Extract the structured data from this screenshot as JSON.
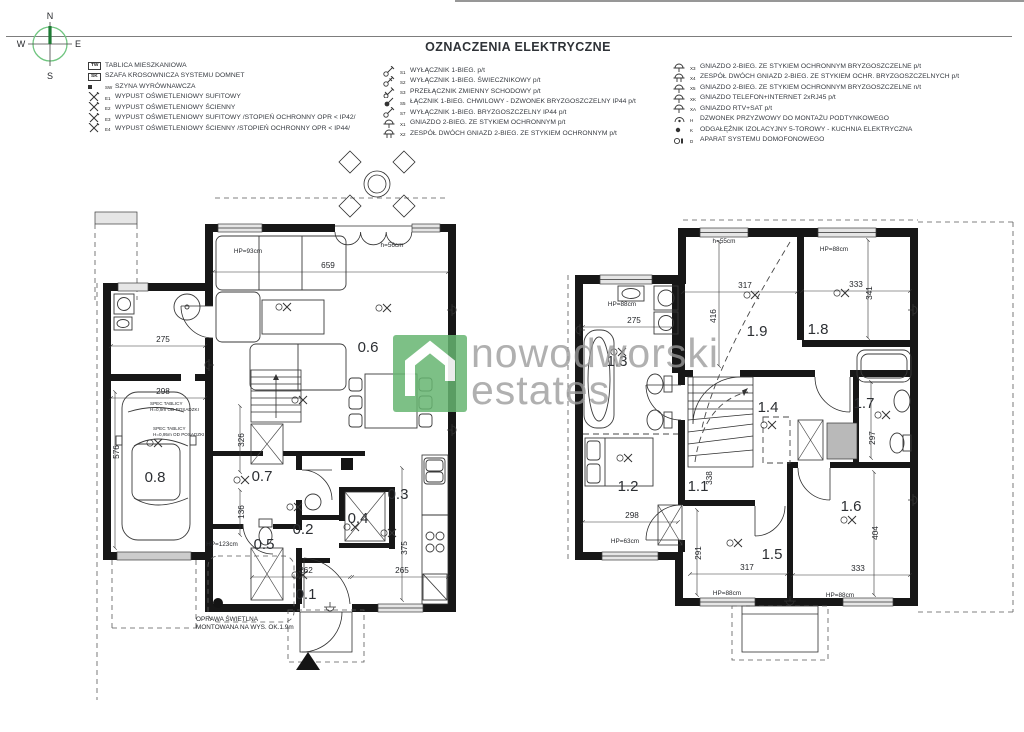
{
  "title": "OZNACZENIA ELEKTRYCZNE",
  "compass": {
    "n": "N",
    "s": "S",
    "w": "W",
    "e": "E"
  },
  "watermark": {
    "line1": "nowodworski",
    "line2": "estates",
    "green": "#66b571",
    "gray": "#9b9b9b"
  },
  "legend": {
    "columns": [
      {
        "rows": [
          {
            "icon": "box",
            "code": "TW",
            "label": "TABLICA MIESZKANIOWA"
          },
          {
            "icon": "box",
            "code": "SK",
            "label": "SZAFA KROSOWNICZA SYSTEMU DOMNET"
          },
          {
            "icon": "square",
            "code": "SW",
            "label": "SZYNA WYRÓWNAWCZA"
          },
          {
            "icon": "lamp",
            "code": "E1",
            "label": "WYPUST OŚWIETLENIOWY SUFITOWY"
          },
          {
            "icon": "lamp",
            "code": "E2",
            "label": "WYPUST OŚWIETLENIOWY ŚCIENNY"
          },
          {
            "icon": "lamp",
            "code": "E3",
            "label": "WYPUST OŚWIETLENIOWY SUFITOWY  /STOPIEŃ OCHRONNY OPR < IP42/"
          },
          {
            "icon": "lamp",
            "code": "E4",
            "label": "WYPUST OŚWIETLENIOWY ŚCIENNY /STOPIEŃ OCHRONNY OPR < IP44/"
          }
        ]
      },
      {
        "rows": [
          {
            "icon": "switch1",
            "code": "S1",
            "label": "WYŁĄCZNIK 1-BIEG. p/t"
          },
          {
            "icon": "switch2",
            "code": "S2",
            "label": "WYŁĄCZNIK 1-BIEG. ŚWIECZNIKOWY p/t"
          },
          {
            "icon": "switch3",
            "code": "S3",
            "label": "PRZEŁĄCZNIK ZMIENNY SCHODOWY p/t"
          },
          {
            "icon": "bell",
            "code": "S5",
            "label": "ŁĄCZNIK 1-BIEG. CHWILOWY - DZWONEK BRYZGOSZCZELNY IP44 p/t"
          },
          {
            "icon": "switch1",
            "code": "S7",
            "label": "WYŁĄCZNIK 1-BIEG. BRYZGOSZCZELNY IP44 p/t"
          },
          {
            "icon": "socket",
            "code": "X1",
            "label": "GNIAZDO 2-BIEG. ZE STYKIEM OCHRONNYM p/t"
          },
          {
            "icon": "socket2",
            "code": "X2",
            "label": "ZESPÓŁ DWÓCH GNIAZD 2-BIEG. ZE STYKIEM OCHRONNYM p/t"
          }
        ]
      },
      {
        "rows": [
          {
            "icon": "socket",
            "code": "X3",
            "label": "GNIAZDO 2-BIEG. ZE STYKIEM OCHRONNYM BRYZGOSZCZELNE p/t"
          },
          {
            "icon": "socket2",
            "code": "X4",
            "label": "ZESPÓŁ DWÓCH GNIAZD 2-BIEG. ZE STYKIEM OCHR. BRYZGOSZCZELNYCH p/t"
          },
          {
            "icon": "socket",
            "code": "X5",
            "label": "GNIAZDO 2-BIEG. ZE STYKIEM OCHRONNYM BRYZGOSZCZELNE n/t"
          },
          {
            "icon": "socket",
            "code": "XK",
            "label": "GNIAZDO TELEFON+INTERNET 2xRJ45 p/t"
          },
          {
            "icon": "socket",
            "code": "XA",
            "label": "GNIAZDO RTV+SAT p/t"
          },
          {
            "icon": "bell2",
            "code": "H",
            "label": "DZWONEK PRZYZWOWY DO MONTAŻU PODTYNKOWEGO"
          },
          {
            "icon": "dot",
            "code": "K",
            "label": "ODGAŁĘŹNIK IZOLACYJNY 5-TOROWY - KUCHNIA ELEKTRYCZNA"
          },
          {
            "icon": "intercom",
            "code": "D",
            "label": "APARAT SYSTEMU DOMOFONOWEGO"
          }
        ]
      }
    ]
  },
  "plan1": {
    "name": "ground-floor-plan",
    "labels": [
      {
        "t": "0.6",
        "x": 368,
        "y": 352,
        "cls": "room"
      },
      {
        "t": "0.7",
        "x": 262,
        "y": 481,
        "cls": "room"
      },
      {
        "t": "0.8",
        "x": 155,
        "y": 482,
        "cls": "room"
      },
      {
        "t": "0.3",
        "x": 398,
        "y": 499,
        "cls": "room"
      },
      {
        "t": "0.2",
        "x": 303,
        "y": 534,
        "cls": "room"
      },
      {
        "t": "0.4",
        "x": 358,
        "y": 523,
        "cls": "room"
      },
      {
        "t": "0.5",
        "x": 264,
        "y": 549,
        "cls": "room"
      },
      {
        "t": "0.1",
        "x": 306,
        "y": 599,
        "cls": "room"
      },
      {
        "t": "659",
        "x": 328,
        "y": 268,
        "cls": "dm"
      },
      {
        "t": "275",
        "x": 163,
        "y": 342,
        "cls": "dm"
      },
      {
        "t": "298",
        "x": 163,
        "y": 394,
        "cls": "dm"
      },
      {
        "t": "262",
        "x": 306,
        "y": 573,
        "cls": "dm"
      },
      {
        "t": "265",
        "x": 402,
        "y": 573,
        "cls": "dm"
      },
      {
        "t": "326",
        "x": 244,
        "y": 440,
        "cls": "dm",
        "rot": 1
      },
      {
        "t": "136",
        "x": 244,
        "y": 512,
        "cls": "dm",
        "rot": 1
      },
      {
        "t": "576",
        "x": 119,
        "y": 452,
        "cls": "dm",
        "rot": 1
      },
      {
        "t": "375",
        "x": 407,
        "y": 548,
        "cls": "dm",
        "rot": 1
      },
      {
        "t": "HP=93cm",
        "x": 248,
        "y": 253,
        "cls": "nt"
      },
      {
        "t": "h=56cm",
        "x": 392,
        "y": 247,
        "cls": "nt"
      },
      {
        "t": "HP=123cm",
        "x": 222,
        "y": 546,
        "cls": "nt"
      },
      {
        "t": "OPRAWA ŚWIETLNA",
        "x": 196,
        "y": 621,
        "cls": "nts"
      },
      {
        "t": "MONTOWANA NA WYS. OK.1.9m",
        "x": 196,
        "y": 629,
        "cls": "nts"
      },
      {
        "t": "SPEC TABLICY",
        "x": 150,
        "y": 405,
        "cls": "tiny"
      },
      {
        "t": "H=0,9m OD POSADZKI",
        "x": 150,
        "y": 411,
        "cls": "tiny"
      },
      {
        "t": "SPEC TABLICY",
        "x": 153,
        "y": 430,
        "cls": "tiny"
      },
      {
        "t": "H=0,95m OD POSADZKI",
        "x": 153,
        "y": 436,
        "cls": "tiny"
      }
    ]
  },
  "plan2": {
    "name": "first-floor-plan",
    "labels": [
      {
        "t": "1.3",
        "x": 617,
        "y": 366,
        "cls": "room"
      },
      {
        "t": "1.9",
        "x": 757,
        "y": 336,
        "cls": "room"
      },
      {
        "t": "1.8",
        "x": 818,
        "y": 334,
        "cls": "room"
      },
      {
        "t": "1.4",
        "x": 768,
        "y": 412,
        "cls": "room"
      },
      {
        "t": "1.7",
        "x": 864,
        "y": 408,
        "cls": "room"
      },
      {
        "t": "1.1",
        "x": 698,
        "y": 491,
        "cls": "room"
      },
      {
        "t": "1.2",
        "x": 628,
        "y": 491,
        "cls": "room"
      },
      {
        "t": "1.5",
        "x": 772,
        "y": 559,
        "cls": "room"
      },
      {
        "t": "1.6",
        "x": 851,
        "y": 511,
        "cls": "room"
      },
      {
        "t": "317",
        "x": 745,
        "y": 288,
        "cls": "dm"
      },
      {
        "t": "333",
        "x": 856,
        "y": 287,
        "cls": "dm"
      },
      {
        "t": "275",
        "x": 634,
        "y": 323,
        "cls": "dm"
      },
      {
        "t": "298",
        "x": 632,
        "y": 518,
        "cls": "dm"
      },
      {
        "t": "317",
        "x": 747,
        "y": 570,
        "cls": "dm"
      },
      {
        "t": "333",
        "x": 858,
        "y": 571,
        "cls": "dm"
      },
      {
        "t": "416",
        "x": 716,
        "y": 316,
        "cls": "dm",
        "rot": 1
      },
      {
        "t": "341",
        "x": 872,
        "y": 293,
        "cls": "dm",
        "rot": 1
      },
      {
        "t": "338",
        "x": 712,
        "y": 478,
        "cls": "dm",
        "rot": 1
      },
      {
        "t": "291",
        "x": 701,
        "y": 553,
        "cls": "dm",
        "rot": 1
      },
      {
        "t": "404",
        "x": 878,
        "y": 533,
        "cls": "dm",
        "rot": 1
      },
      {
        "t": "297",
        "x": 875,
        "y": 438,
        "cls": "dm",
        "rot": 1
      },
      {
        "t": "HP=88cm",
        "x": 834,
        "y": 251,
        "cls": "nt"
      },
      {
        "t": "h=55cm",
        "x": 724,
        "y": 243,
        "cls": "nt"
      },
      {
        "t": "HP=88cm",
        "x": 622,
        "y": 306,
        "cls": "nt"
      },
      {
        "t": "HP=63cm",
        "x": 625,
        "y": 543,
        "cls": "nt"
      },
      {
        "t": "HP=88cm",
        "x": 727,
        "y": 595,
        "cls": "nt"
      },
      {
        "t": "HP=88cm",
        "x": 840,
        "y": 597,
        "cls": "nt"
      }
    ]
  }
}
